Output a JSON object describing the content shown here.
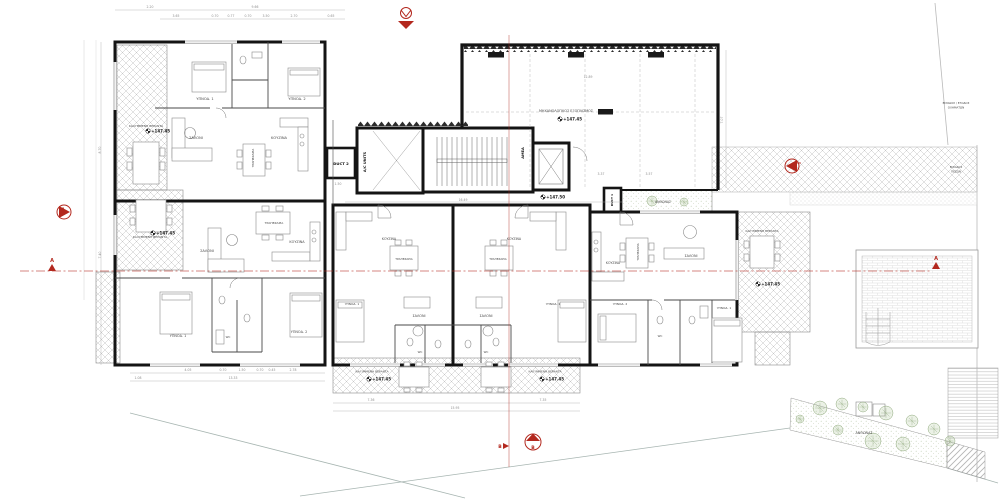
{
  "drawing": {
    "type_label": "apartment-building-floor-plan",
    "colors": {
      "wall": "#141414",
      "partition": "#4a4a4a",
      "hatch": "#c6c6c6",
      "section_red": "#b3281e",
      "dim_gray": "#8f8f8f",
      "tree_green": "#8fa97c"
    },
    "rooms": [
      {
        "name": "bedroom1-aptA",
        "text": "ΥΠΝΟΔ. 1",
        "x": 205,
        "y": 100
      },
      {
        "name": "bedroom2-aptA",
        "text": "ΥΠΝΟΔ. 2",
        "x": 297,
        "y": 100
      },
      {
        "name": "living-aptA",
        "text": "ΣΑΛΟΝΙ",
        "x": 196,
        "y": 139
      },
      {
        "name": "kitchen-aptA",
        "text": "ΚΟΥΖΙΝΑ",
        "x": 279,
        "y": 139
      },
      {
        "name": "dining-aptA",
        "text": "ΤΡΑΠΕΖΑΡΙΑ",
        "x": 254,
        "y": 158,
        "rot": -90,
        "fs": 3
      },
      {
        "name": "veranda-aptA",
        "text": "ΚΑΛΥΜΜΕΝΗ ΒΕΡΑΝΤΑ",
        "x": 146,
        "y": 127,
        "fs": 3
      },
      {
        "name": "living-aptB",
        "text": "ΣΑΛΟΝΙ",
        "x": 207,
        "y": 252
      },
      {
        "name": "dining-aptB",
        "text": "ΤΡΑΠΕΖΑΡΙΑ",
        "x": 274,
        "y": 224,
        "fs": 3
      },
      {
        "name": "kitchen-aptB",
        "text": "ΚΟΥΖΙΝΑ",
        "x": 297,
        "y": 243,
        "fs": 3.4
      },
      {
        "name": "bedroom1-aptB",
        "text": "ΥΠΝΟΔ. 1",
        "x": 178,
        "y": 337,
        "fs": 3.4
      },
      {
        "name": "bedroom2-aptB",
        "text": "ΥΠΝΟΔ. 2",
        "x": 299,
        "y": 333,
        "fs": 3.4
      },
      {
        "name": "wc-aptB",
        "text": "WC",
        "x": 228,
        "y": 338,
        "fs": 2.8
      },
      {
        "name": "veranda-aptB",
        "text": "ΚΑΛΥΜΜΕΝΗ ΒΕΡΑΝΤΑ",
        "x": 150,
        "y": 238,
        "fs": 3
      },
      {
        "name": "duct2",
        "text": "DUCT 2",
        "x": 341,
        "y": 165,
        "fs": 3.8,
        "bold": true
      },
      {
        "name": "ac-units",
        "text": "A/C UNITS",
        "x": 366,
        "y": 162,
        "rot": -90,
        "fs": 3.6,
        "bold": true
      },
      {
        "name": "amea",
        "text": "ΑΜΕΑ",
        "x": 524,
        "y": 153,
        "rot": -90,
        "fs": 3.6,
        "bold": true
      },
      {
        "name": "duct1",
        "text": "DUCT 1",
        "x": 613,
        "y": 200,
        "rot": -90,
        "fs": 3,
        "bold": true
      },
      {
        "name": "planter-core",
        "text": "ΑΝΘΩΝΑΣ",
        "x": 663,
        "y": 203,
        "fs": 3.2
      },
      {
        "name": "mechanical-area",
        "text": "ΜΗΧΑΝΟΛΟΓΙΚΟΣ ΕΞΟΠΛΙΣΜΟΣ",
        "x": 566,
        "y": 112,
        "fs": 3.4
      },
      {
        "name": "kitchen-aptC",
        "text": "ΚΟΥΖΙΝΑ",
        "x": 389,
        "y": 240,
        "fs": 3.2
      },
      {
        "name": "dining-aptC",
        "text": "ΤΡΑΠΕΖΑΡΙΑ",
        "x": 404,
        "y": 260,
        "fs": 2.8
      },
      {
        "name": "living-aptC",
        "text": "ΣΑΛΟΝΙ",
        "x": 419,
        "y": 317,
        "fs": 3.4
      },
      {
        "name": "bedroom1-aptC",
        "text": "ΥΠΝΟΔ. 1",
        "x": 352,
        "y": 305,
        "fs": 3
      },
      {
        "name": "kitchen-aptD",
        "text": "ΚΟΥΖΙΝΑ",
        "x": 514,
        "y": 240,
        "fs": 3.2
      },
      {
        "name": "dining-aptD",
        "text": "ΤΡΑΠΕΖΑΡΙΑ",
        "x": 498,
        "y": 260,
        "fs": 2.8
      },
      {
        "name": "living-aptD",
        "text": "ΣΑΛΟΝΙ",
        "x": 486,
        "y": 317,
        "fs": 3.4
      },
      {
        "name": "bedroom1-aptD",
        "text": "ΥΠΝΟΔ. 1",
        "x": 553,
        "y": 305,
        "fs": 3
      },
      {
        "name": "wc-aptC",
        "text": "WC",
        "x": 420,
        "y": 353,
        "fs": 2.8
      },
      {
        "name": "wc-aptD",
        "text": "WC",
        "x": 486,
        "y": 353,
        "fs": 2.8
      },
      {
        "name": "veranda-aptC",
        "text": "ΚΑΛΥΜΜΕΝΗ ΒΕΡΑΝΤΑ",
        "x": 372,
        "y": 372.5,
        "fs": 2.9
      },
      {
        "name": "veranda-aptD",
        "text": "ΚΑΛΥΜΜΕΝΗ ΒΕΡΑΝΤΑ",
        "x": 545,
        "y": 372.5,
        "fs": 2.9
      },
      {
        "name": "kitchen-aptE",
        "text": "ΚΟΥΖΙΝΑ",
        "x": 613,
        "y": 264,
        "fs": 3.2
      },
      {
        "name": "dining-aptE",
        "text": "ΤΡΑΠΕΖΑΡΙΑ",
        "x": 639,
        "y": 252,
        "rot": -90,
        "fs": 2.8
      },
      {
        "name": "living-aptE",
        "text": "ΣΑΛΟΝΙ",
        "x": 691,
        "y": 257,
        "fs": 3.4
      },
      {
        "name": "bedroom2-aptE",
        "text": "ΥΠΝΟΔ. 2",
        "x": 620,
        "y": 305,
        "fs": 3
      },
      {
        "name": "bedroom1-aptE",
        "text": "ΥΠΝΟΔ. 1",
        "x": 724,
        "y": 309,
        "fs": 3
      },
      {
        "name": "wc-aptE",
        "text": "WC",
        "x": 660,
        "y": 337,
        "fs": 2.8
      },
      {
        "name": "veranda-aptE",
        "text": "ΚΑΛΥΜΜΕΝΗ ΒΕΡΑΝΤΑ",
        "x": 762,
        "y": 232,
        "fs": 2.9
      },
      {
        "name": "garden-planter",
        "text": "ΑΝΘΩΝΑΣ",
        "x": 864,
        "y": 434,
        "fs": 3.4
      },
      {
        "name": "entrance-vehicles-line1",
        "text": "ΕΙΣΟΔΟΣ / ΕΞΟΔΟΣ",
        "x": 956,
        "y": 104,
        "fs": 2.8
      },
      {
        "name": "entrance-vehicles-line2",
        "text": "ΟΧΗΜΑΤΩΝ",
        "x": 956,
        "y": 108.5,
        "fs": 2.8
      },
      {
        "name": "entrance-pedestrians-line1",
        "text": "ΕΙΣΟΔΟΣ",
        "x": 956,
        "y": 168,
        "fs": 2.8
      },
      {
        "name": "entrance-pedestrians-line2",
        "text": "ΠΕΖΩΝ",
        "x": 956,
        "y": 172.5,
        "fs": 2.8
      }
    ],
    "elevations": [
      {
        "name": "level-veranda-aptA",
        "x": 148,
        "y": 131,
        "value": "+147.45"
      },
      {
        "name": "level-veranda-aptB",
        "x": 153,
        "y": 233,
        "value": "+147.45"
      },
      {
        "name": "level-mechanical",
        "x": 560,
        "y": 119,
        "value": "+147.45"
      },
      {
        "name": "level-entrance-core",
        "x": 543,
        "y": 197,
        "value": "+147.50"
      },
      {
        "name": "level-veranda-aptC",
        "x": 369,
        "y": 379,
        "value": "+147.45"
      },
      {
        "name": "level-veranda-aptD",
        "x": 542,
        "y": 379,
        "value": "+147.45"
      },
      {
        "name": "level-veranda-aptE",
        "x": 758,
        "y": 284,
        "value": "+147.45"
      }
    ],
    "dimensions": [
      {
        "x": 150,
        "y": 8,
        "text": "2.20"
      },
      {
        "x": 255,
        "y": 8,
        "text": "9.66"
      },
      {
        "x": 176,
        "y": 17,
        "text": "3.65"
      },
      {
        "x": 215,
        "y": 17,
        "text": "0.70"
      },
      {
        "x": 231,
        "y": 17,
        "text": "0.77"
      },
      {
        "x": 248,
        "y": 17,
        "text": "0.70"
      },
      {
        "x": 266,
        "y": 17,
        "text": "3.50"
      },
      {
        "x": 294,
        "y": 17,
        "text": "2.70"
      },
      {
        "x": 331,
        "y": 17,
        "text": "0.65"
      },
      {
        "x": 463,
        "y": 201,
        "text": "16.49"
      },
      {
        "x": 588,
        "y": 78,
        "text": "12.89"
      },
      {
        "x": 338,
        "y": 185,
        "text": "1.50"
      },
      {
        "x": 601,
        "y": 175,
        "text": "3.37"
      },
      {
        "x": 649,
        "y": 175,
        "text": "3.57"
      },
      {
        "x": 188,
        "y": 371,
        "text": "4.05"
      },
      {
        "x": 223,
        "y": 371,
        "text": "0.70"
      },
      {
        "x": 242,
        "y": 371,
        "text": "1.50"
      },
      {
        "x": 260,
        "y": 371,
        "text": "0.70"
      },
      {
        "x": 272,
        "y": 371,
        "text": "0.45"
      },
      {
        "x": 293,
        "y": 371,
        "text": "2.78"
      },
      {
        "x": 138,
        "y": 379,
        "text": "1.08"
      },
      {
        "x": 233,
        "y": 379,
        "text": "13.33"
      },
      {
        "x": 371,
        "y": 401,
        "text": "7.36"
      },
      {
        "x": 543,
        "y": 401,
        "text": "7.35"
      },
      {
        "x": 455,
        "y": 409,
        "text": "15.95"
      },
      {
        "x": 101,
        "y": 150,
        "text": "8.70",
        "rot": -90
      },
      {
        "x": 101,
        "y": 255,
        "text": "7.40",
        "rot": -90
      },
      {
        "x": 723,
        "y": 120,
        "text": "7.07",
        "rot": -90
      }
    ],
    "markers": {
      "section_a_left": "A",
      "section_a_right": "A",
      "section_b_small": "B",
      "section_b_circle": "B"
    },
    "trees": [
      {
        "x": 652,
        "y": 201,
        "r": 5
      },
      {
        "x": 684,
        "y": 202,
        "r": 4
      },
      {
        "x": 820,
        "y": 408,
        "r": 7
      },
      {
        "x": 842,
        "y": 404,
        "r": 6
      },
      {
        "x": 863,
        "y": 407,
        "r": 5
      },
      {
        "x": 886,
        "y": 413,
        "r": 7
      },
      {
        "x": 912,
        "y": 421,
        "r": 6
      },
      {
        "x": 934,
        "y": 429,
        "r": 6
      },
      {
        "x": 873,
        "y": 441,
        "r": 8
      },
      {
        "x": 903,
        "y": 444,
        "r": 7
      },
      {
        "x": 838,
        "y": 430,
        "r": 5
      },
      {
        "x": 950,
        "y": 441,
        "r": 5
      },
      {
        "x": 800,
        "y": 419,
        "r": 4
      }
    ]
  }
}
